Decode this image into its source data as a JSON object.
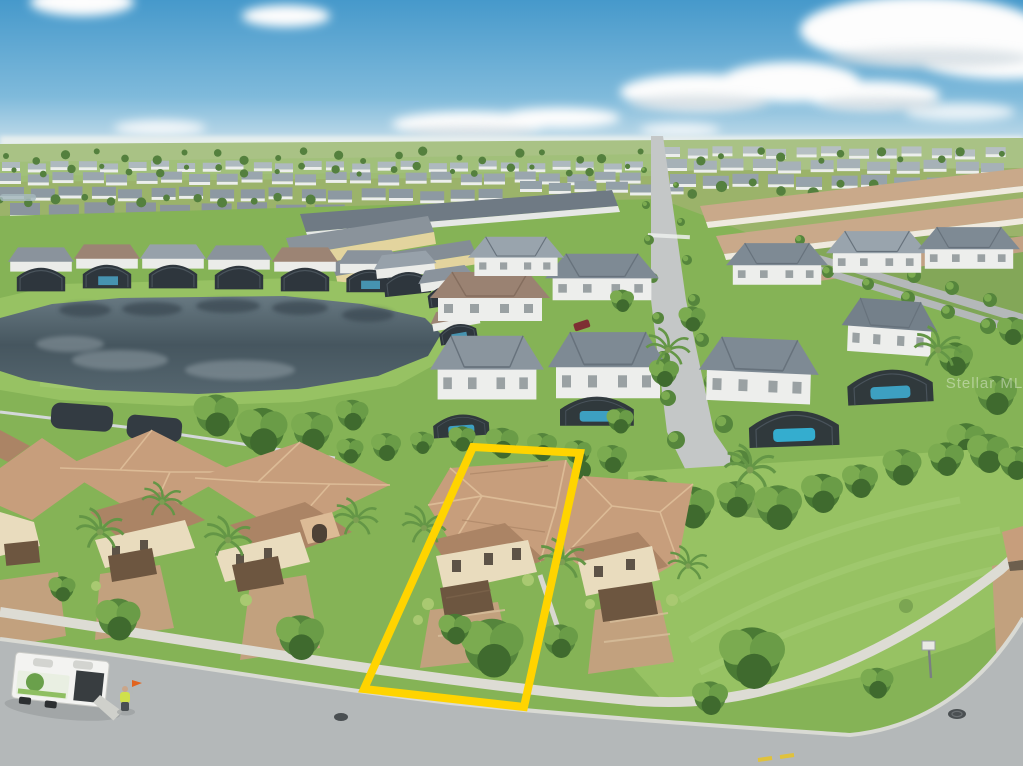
{
  "scene": {
    "type": "aerial-drone-photo",
    "description": "Aerial drone photo of a Florida suburban community: blue sky with cumulus clouds, a gray-blue retention pond ringed by grass, rows of two-story homes with screened pool lanais, a long straight interior street, a tree-lined boulevard, a vacant grassy corner lot, and a foreground row of Mediterranean tan-tile-roof homes along a curving street. One property lot is outlined in yellow.",
    "subject_property": {
      "highlight_points": "473,447 580,453 524,707 364,689",
      "style": "Two-story Mediterranean home, tan tile roof, paver driveway, front shade tree"
    },
    "foreground_street": {
      "truck": "white landscaping box trailer with open ramp",
      "worker": "crew member in safety-yellow shirt with orange flag"
    }
  },
  "watermark": {
    "text": "Stellar MLS"
  },
  "colors": {
    "sky_top": "#4699cb",
    "sky_mid": "#7fbadb",
    "sky_horizon": "#d6e6ee",
    "cloud_white": "#fdfdfd",
    "cloud_shadow": "#c7d3da",
    "haze": "#e6eeee",
    "far_field": "#a9c285",
    "far_tree": "#54803e",
    "grass": "#85b356",
    "grass_bright": "#97c263",
    "grass_dark": "#6f9c49",
    "pond_deep": "#46565f",
    "pond_mid": "#687982",
    "pond_light": "#95a2a9",
    "road": "#b4b8b9",
    "road_far": "#c4c7c7",
    "sidewalk": "#dddcd4",
    "paver": "#c2a17e",
    "paver_light": "#d8bf9c",
    "roof_tan": "#c79e7c",
    "roof_tan_light": "#dcbb96",
    "roof_tan_dark": "#ab8465",
    "wall_cream": "#e9dcbe",
    "wall_white": "#eceeec",
    "roof_gray": "#7e8a94",
    "roof_gray_light": "#99a4ad",
    "roof_gray_dark": "#5c6771",
    "roof_brown": "#9a8272",
    "lanai": "#2e363d",
    "pool": "#3fa9cd",
    "pool_bright": "#35b7dc",
    "tree": "#55853c",
    "tree_light": "#7bab50",
    "tree_mid": "#6a9c47",
    "tree_dark": "#3f6a2e",
    "tan_complex": "#c9a98a",
    "cream_wall": "#e3d49e",
    "highlight": "#ffd400",
    "fence": "#d4d8da",
    "median": "#7fa657",
    "truck": "#f3f3f1",
    "truck_dark": "#383d40",
    "safety": "#cfe04b",
    "flag": "#e2641f",
    "manhole": "#4a4f52"
  },
  "distant": {
    "strips": [
      {
        "x": 2,
        "y": 162,
        "n": 26,
        "w": 18,
        "gap": 7,
        "h": 6,
        "slope": 0,
        "roof": "#aeb9bf"
      },
      {
        "x": 0,
        "y": 173,
        "n": 24,
        "w": 21,
        "gap": 6,
        "h": 8,
        "slope": 0,
        "roof": "#9aa6ae"
      },
      {
        "x": 0,
        "y": 187,
        "n": 17,
        "w": 24,
        "gap": 6,
        "h": 9,
        "slope": 0.2,
        "roof": "#8d99a2"
      },
      {
        "x": 10,
        "y": 203,
        "n": 9,
        "w": 30,
        "gap": 8,
        "h": 12,
        "slope": 0.1,
        "roof": "#8b959e"
      },
      {
        "x": 520,
        "y": 181,
        "n": 6,
        "w": 22,
        "gap": 6,
        "h": 8,
        "slope": 0.5,
        "roof": "#93a0a8"
      },
      {
        "x": 660,
        "y": 147,
        "n": 13,
        "w": 20,
        "gap": 7,
        "h": 7,
        "slope": 0.1,
        "roof": "#b6bfc3"
      },
      {
        "x": 664,
        "y": 159,
        "n": 12,
        "w": 23,
        "gap": 6,
        "h": 9,
        "slope": 0.25,
        "roof": "#a6b1b7"
      },
      {
        "x": 670,
        "y": 174,
        "n": 11,
        "w": 26,
        "gap": 6,
        "h": 10,
        "slope": 0.35,
        "roof": "#97a3ab"
      }
    ],
    "tree_rows": [
      {
        "x": 6,
        "y": 156,
        "n": 34,
        "dx": 30,
        "r": 3,
        "jy": 5
      },
      {
        "x": 14,
        "y": 170,
        "n": 22,
        "dx": 29,
        "r": 2.6,
        "jy": 4
      },
      {
        "x": 0,
        "y": 200,
        "n": 12,
        "dx": 28,
        "r": 3.4,
        "jy": 3
      },
      {
        "x": 662,
        "y": 188,
        "n": 12,
        "dx": 30,
        "r": 4,
        "jy": 6
      }
    ]
  },
  "streets": {
    "central_trees": [
      {
        "x": 644,
        "y": 170,
        "r": 3
      },
      {
        "x": 646,
        "y": 205,
        "r": 4
      },
      {
        "x": 649,
        "y": 240,
        "r": 5
      },
      {
        "x": 653,
        "y": 278,
        "r": 5
      },
      {
        "x": 658,
        "y": 318,
        "r": 6
      },
      {
        "x": 663,
        "y": 358,
        "r": 7
      },
      {
        "x": 668,
        "y": 398,
        "r": 8
      },
      {
        "x": 676,
        "y": 440,
        "r": 9
      },
      {
        "x": 676,
        "y": 185,
        "r": 3
      },
      {
        "x": 681,
        "y": 222,
        "r": 4
      },
      {
        "x": 687,
        "y": 260,
        "r": 5
      },
      {
        "x": 694,
        "y": 300,
        "r": 6
      },
      {
        "x": 702,
        "y": 340,
        "r": 7
      },
      {
        "x": 712,
        "y": 382,
        "r": 8
      },
      {
        "x": 724,
        "y": 424,
        "r": 9
      },
      {
        "x": 740,
        "y": 460,
        "r": 10
      }
    ],
    "boulevard_trees": [
      {
        "x": 800,
        "y": 240,
        "r": 5
      },
      {
        "x": 838,
        "y": 252,
        "r": 6
      },
      {
        "x": 876,
        "y": 264,
        "r": 6
      },
      {
        "x": 914,
        "y": 276,
        "r": 7
      },
      {
        "x": 952,
        "y": 288,
        "r": 7
      },
      {
        "x": 990,
        "y": 300,
        "r": 7
      },
      {
        "x": 828,
        "y": 272,
        "r": 6
      },
      {
        "x": 868,
        "y": 284,
        "r": 6
      },
      {
        "x": 908,
        "y": 298,
        "r": 7
      },
      {
        "x": 948,
        "y": 312,
        "r": 7
      },
      {
        "x": 988,
        "y": 326,
        "r": 8
      },
      {
        "x": 1016,
        "y": 336,
        "r": 7
      }
    ]
  }
}
